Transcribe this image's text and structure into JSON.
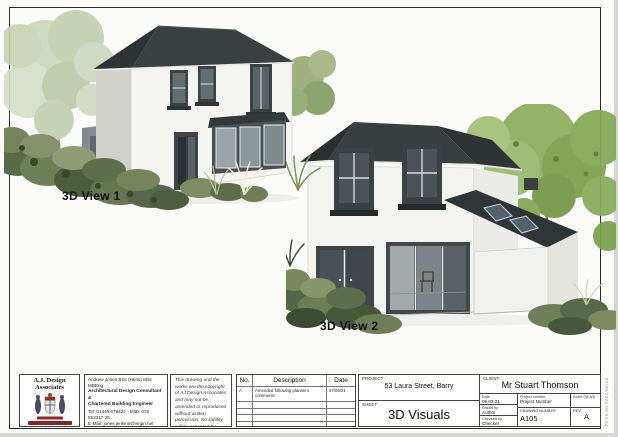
{
  "sheet": {
    "view1_label": "3D View 1",
    "view2_label": "3D View 2",
    "side_timestamp": "07/09/2021 09:54:44"
  },
  "titleblock": {
    "company": {
      "name": "A.J. Design Associates",
      "tagline1": "Specialists in Architectural Design Drawing",
      "tagline2": "& Building Engineering"
    },
    "contact": {
      "line1": "Andrew Jones BSc (Hons) MSc MBEng",
      "line2": "Architectural Design Consultant &",
      "line3": "Chartered Building Engineer",
      "line4": "Tel: 01446 679422 - Mob: 078 553317 28",
      "line5": "E-Mail: jones.jenkins@virgin.net",
      "line6": "THE STUDIO, Whips Bungalow,",
      "line7": "Llandough, Cowbridge,",
      "line8": "Vale of Glamorgan, CF71 7LR."
    },
    "copyright": "This drawing and the works are the copyright of AJ Design Associates and may not be amended or reproduced without written permission. No liability will be accepted for amendments made by a third party.",
    "revisions": {
      "col_no": "No.",
      "col_description": "Description",
      "col_date": "Date",
      "rows": [
        {
          "no": "A",
          "description": "Amended following planners comments",
          "date": "07/09/21"
        }
      ]
    },
    "project_label": "PROJECT",
    "project_value": "53 Laura Street, Barry",
    "sheet_label": "SHEET",
    "sheet_value": "3D Visuals",
    "client_label": "CLIENT",
    "client_value": "Mr Stuart Thomson",
    "meta": {
      "date_label": "Date",
      "date_value": "09.03.21",
      "drawn_label": "Drawn by",
      "drawn_value": "Author",
      "checked_label": "Checked by",
      "checked_value": "Checker",
      "project_number_label": "Project number",
      "project_number_value": "Project Number",
      "scale_label": "Scale (@ A3)",
      "scale_value": "",
      "drawing_number_label": "DRAWING NUMBER",
      "drawing_number_value": "A105",
      "rev_label": "REV",
      "rev_value": "A"
    }
  },
  "colors": {
    "roof": "#383d40",
    "wall": "#f3f3f0",
    "foliage_light": "#c9d3b6",
    "foliage_bright": "#8fb062",
    "crest_red": "#8a2a2b"
  }
}
